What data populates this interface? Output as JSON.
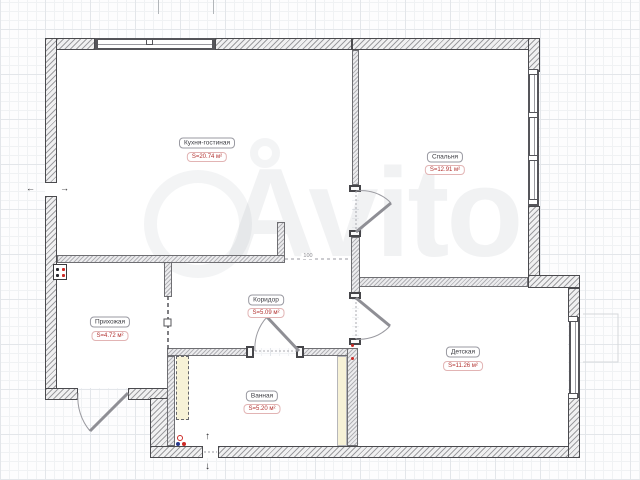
{
  "plan": {
    "rooms": [
      {
        "name": "Кухня-гостиная",
        "area": "S=20.74 м²"
      },
      {
        "name": "Спальня",
        "area": "S=12.91 м²"
      },
      {
        "name": "Коридор",
        "area": "S=5.09 м²"
      },
      {
        "name": "Прихожая",
        "area": "S=4.72 м²"
      },
      {
        "name": "Детская",
        "area": "S=11.26 м²"
      },
      {
        "name": "Ванная",
        "area": "S=5.20 м²"
      }
    ],
    "dimension_label": "100",
    "icons": {
      "entry_up": "↑",
      "entry_down": "↓",
      "opening_left": "←",
      "opening_right": "→"
    },
    "colors": {
      "area_text": "#b23230",
      "label_text": "#3c3c42",
      "wall_outline": "#4a4a4e",
      "accent_red": "#cc2a26",
      "accent_blue": "#2a3a8c",
      "cabinet_fill": "#f7f2d7"
    }
  },
  "watermark": {
    "text": "Avito"
  }
}
